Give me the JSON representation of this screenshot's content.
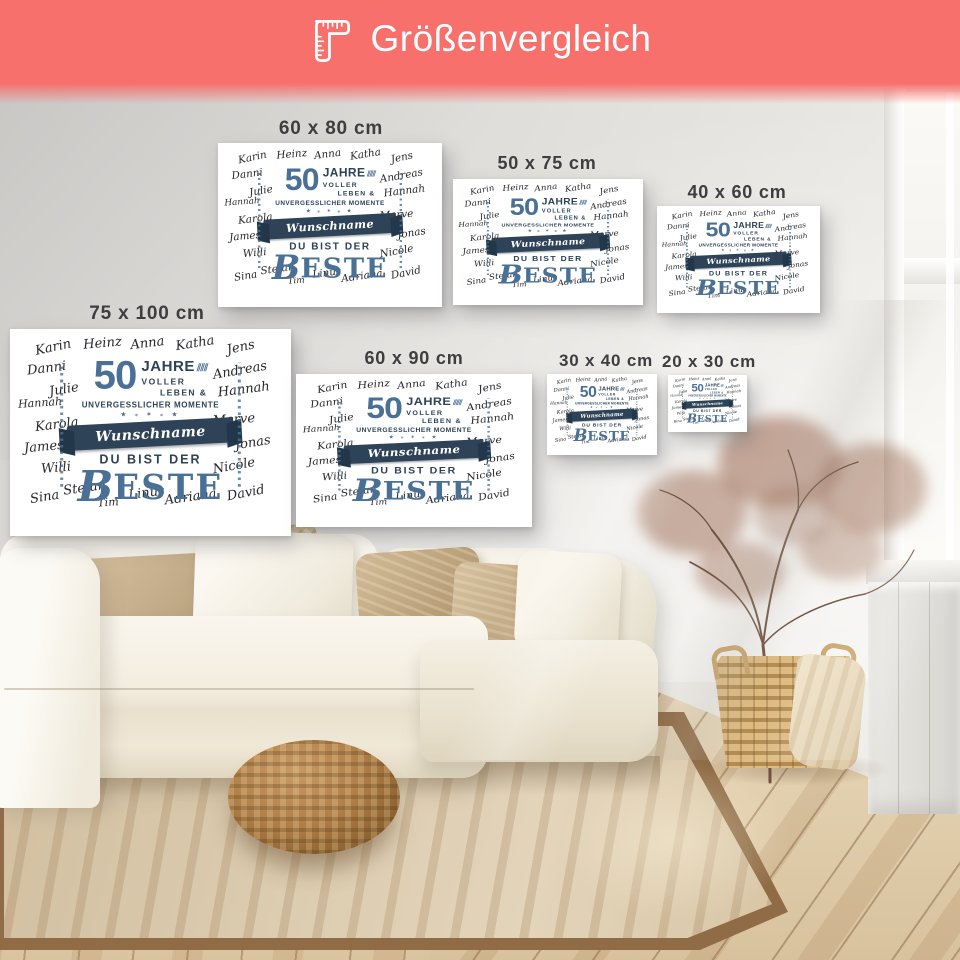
{
  "header": {
    "title": "Größenvergleich"
  },
  "colors": {
    "banner": "#F7706C",
    "accent_blue": "#4A7195",
    "navy": "#2E4357",
    "label_text": "#3E3E41"
  },
  "sizes": [
    {
      "label": "60 x 80 cm"
    },
    {
      "label": "50 x 75 cm"
    },
    {
      "label": "40 x 60 cm"
    },
    {
      "label": "75 x 100 cm"
    },
    {
      "label": "60 x 90 cm"
    },
    {
      "label": "30 x 40 cm"
    },
    {
      "label": "20 x 30 cm"
    }
  ],
  "artwork": {
    "names": [
      "Karin",
      "Heinz",
      "Anna",
      "Katha",
      "Jens",
      "Danni",
      "Andreas",
      "Julie",
      "Hannah",
      "Hannah",
      "Karola",
      "Merve",
      "James",
      "Jonas",
      "Willi",
      "Nicole",
      "Sina",
      "Stefan",
      "Tim",
      "Linus",
      "Adriana",
      "David"
    ],
    "number": "50",
    "jahre": "JAHRE",
    "voller": "VOLLER",
    "leben": "LEBEN &",
    "momente": "UNVERGESSLICHER MOMENTE",
    "ribbon": "Wunschname",
    "du_bist_der": "DU BIST DER",
    "beste": "BESTE",
    "decor_laurel": "⫽⫽⫽",
    "decor_stars": "★ ⁎ ✶ ⁎ ★"
  }
}
